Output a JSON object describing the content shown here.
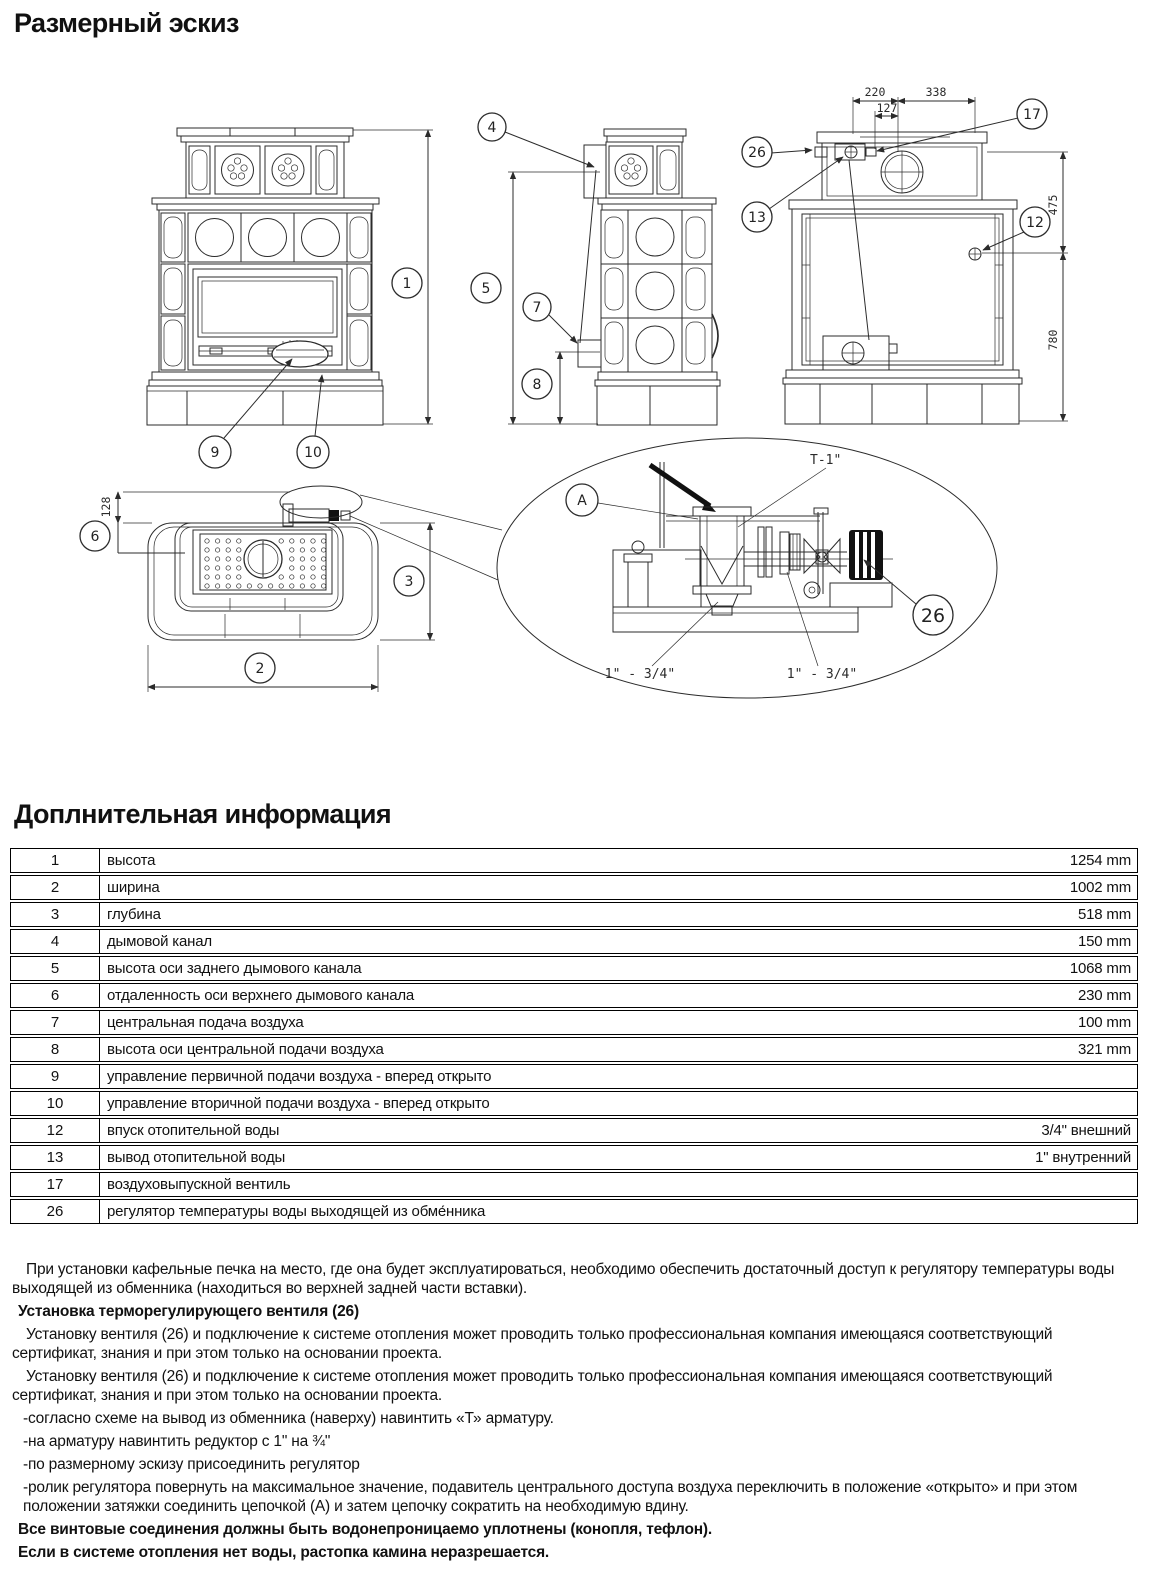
{
  "page": {
    "title1": "Размерный эскиз",
    "title2": "Доплнительная информация"
  },
  "drawing": {
    "callouts": {
      "c1": "1",
      "c2": "2",
      "c3": "3",
      "c4": "4",
      "c5": "5",
      "c6": "6",
      "c7": "7",
      "c8": "8",
      "c9": "9",
      "c10": "10",
      "c12": "12",
      "c13": "13",
      "c17": "17",
      "c26": "26",
      "cA": "A",
      "c26d": "26"
    },
    "dims": {
      "d220": "220",
      "d338": "338",
      "d127": "127",
      "d475": "475",
      "d780": "780",
      "d128": "128"
    },
    "labels": {
      "t_fitting": "T-1\"",
      "reducer_left": "1\" - 3/4\"",
      "reducer_right": "1\" - 3/4\""
    }
  },
  "table": {
    "rows": [
      {
        "num": "1",
        "desc": "высота",
        "value": "1254 mm"
      },
      {
        "num": "2",
        "desc": "ширина",
        "value": "1002 mm"
      },
      {
        "num": "3",
        "desc": "глубина",
        "value": "518 mm"
      },
      {
        "num": "4",
        "desc": "дымовой канал",
        "value": "150 mm"
      },
      {
        "num": "5",
        "desc": "высота оси заднего дымового канала",
        "value": "1068 mm"
      },
      {
        "num": "6",
        "desc": "отдаленность оси верхнего дымового канала",
        "value": "230 mm"
      },
      {
        "num": "7",
        "desc": "центральная подача воздуха",
        "value": "100 mm"
      },
      {
        "num": "8",
        "desc": "высота оси центральной подачи воздуха",
        "value": "321 mm"
      },
      {
        "num": "9",
        "desc": "управление первичной подачи воздуха - вперед открыто",
        "value": ""
      },
      {
        "num": "10",
        "desc": "управление вторичной подачи воздуха - вперед открыто",
        "value": ""
      },
      {
        "num": "12",
        "desc": "впуск отопительной воды",
        "value": "3/4\" внешний"
      },
      {
        "num": "13",
        "desc": "вывод отопительной воды",
        "value": "1\" внутренний"
      },
      {
        "num": "17",
        "desc": "воздуховыпускной вентиль",
        "value": ""
      },
      {
        "num": "26",
        "desc": "регулятор температуры воды выходящей из обме́нника",
        "value": ""
      }
    ]
  },
  "notes": {
    "p1": "При установки кафельные печка на место, где она будет эксплуатироваться, необходимо обеспечить достаточный доступ к регулятору температуры воды выходящей из обменника (находиться во верхней задней части вставки).",
    "h1": "Установка терморегулирующего вентиля (26)",
    "p2": "Установку вентиля (26) и подключение к системе отопления может проводить только профессиональная компания имеющаяся соответствующий сертификат, знания и при этом только на основании проекта.",
    "p3": "Установку вентиля (26) и подключение к системе отопления может проводить только профессиональная компания имеющаяся соответствующий сертификат, знания и при этом только на основании проекта.",
    "li1": "-согласно схеме на вывод из обменника (наверху) навинтить «Т» арматуру.",
    "li2": "-на арматуру навинтить редуктор с 1\" на ¾\"",
    "li3": "-по размерному эскизу присоединить регулятор",
    "p4": "-ролик регулятора повернуть на максимальное значение, подавитель центрального доступа воздуха переключить в положение «открыто» и при этом положении затяжки соединить цепочкой (А) и затем цепочку сократить на необходимую вдину.",
    "b1": "Все винтовые соединения должны быть водонепроницаемо уплотнены (конопля, тефлон).",
    "b2": "Если в системе отопления нет воды, растопка камина неразрешается."
  }
}
